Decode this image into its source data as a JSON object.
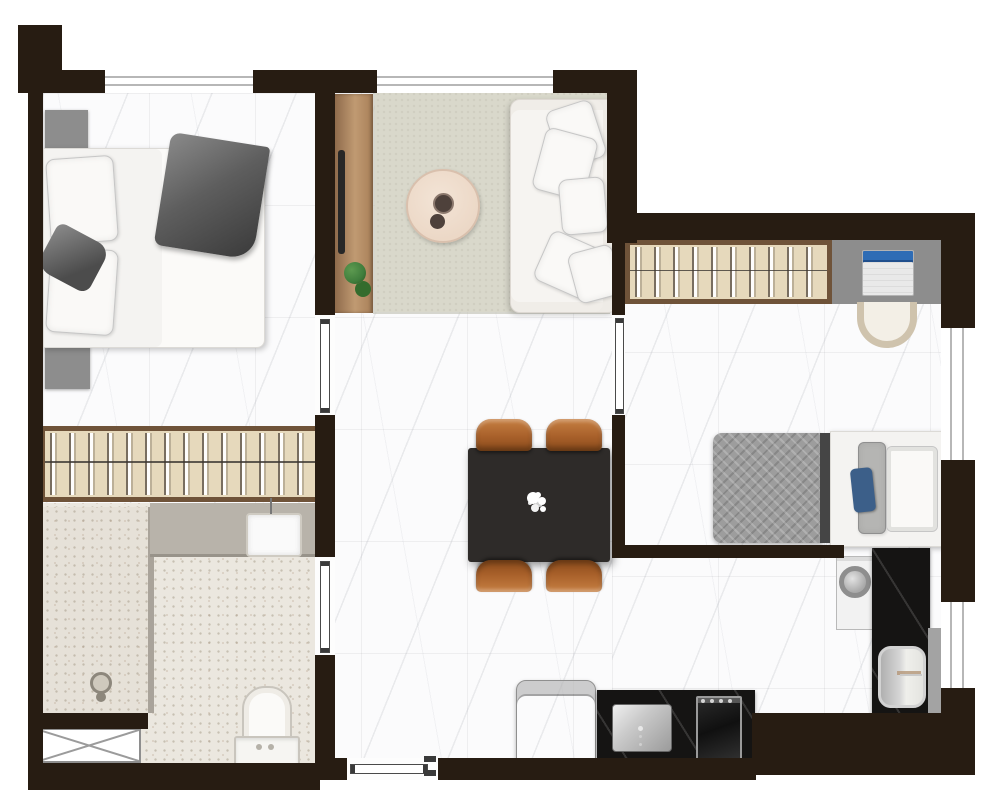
{
  "page": {
    "title": "apartment-floor-plan",
    "canvas_width": 1000,
    "canvas_height": 811
  },
  "palette": {
    "wall": "#271c12",
    "floor": "#fbfbfc",
    "bath_floor": "#ebe7df",
    "rug": "#d9d8cb",
    "wood": "#c09a72",
    "wood_dark": "#8a6647",
    "wardrobe_bg": "#e6d9bc",
    "wardrobe_border": "#6f5339",
    "counter_black": "#151413",
    "gray_furniture": "#8d8d8d",
    "vanity_counter": "#b8b3aa",
    "chair_orange": "#a8602a",
    "table_dark": "#2e2b29",
    "metal_dark": "#9b9b9b",
    "bed_white": "#f4f3f1",
    "quilt_gray": "#9d9d9d",
    "blanket_gray": "#5e5e5e",
    "plant_green": "#3f7d3c",
    "laptop_blue": "#2e6cb5",
    "pillow_blue": "#3c5f89",
    "pillow_border": "#c6c6c6",
    "window_line": "#b7b7b7",
    "door_line": "#4a4a4a",
    "shaft_line": "#8e8e8e"
  },
  "rooms": [
    "master-bedroom",
    "living-room",
    "dining-hall",
    "kitchen",
    "bathroom-main",
    "bedroom-2",
    "bathroom-2"
  ],
  "furniture": [
    "double-bed",
    "nightstand",
    "wardrobe",
    "tv-console",
    "plant",
    "area-rug",
    "coffee-table",
    "sofa",
    "dining-table",
    "dining-chair",
    "flower-centerpiece",
    "single-bed",
    "desk",
    "laptop",
    "desk-chair",
    "refrigerator",
    "kitchen-sink",
    "cooktop",
    "washing-machine",
    "vanity-sink",
    "toilet",
    "shower-drain",
    "service-shaft",
    "entry-door",
    "interior-door",
    "window"
  ]
}
